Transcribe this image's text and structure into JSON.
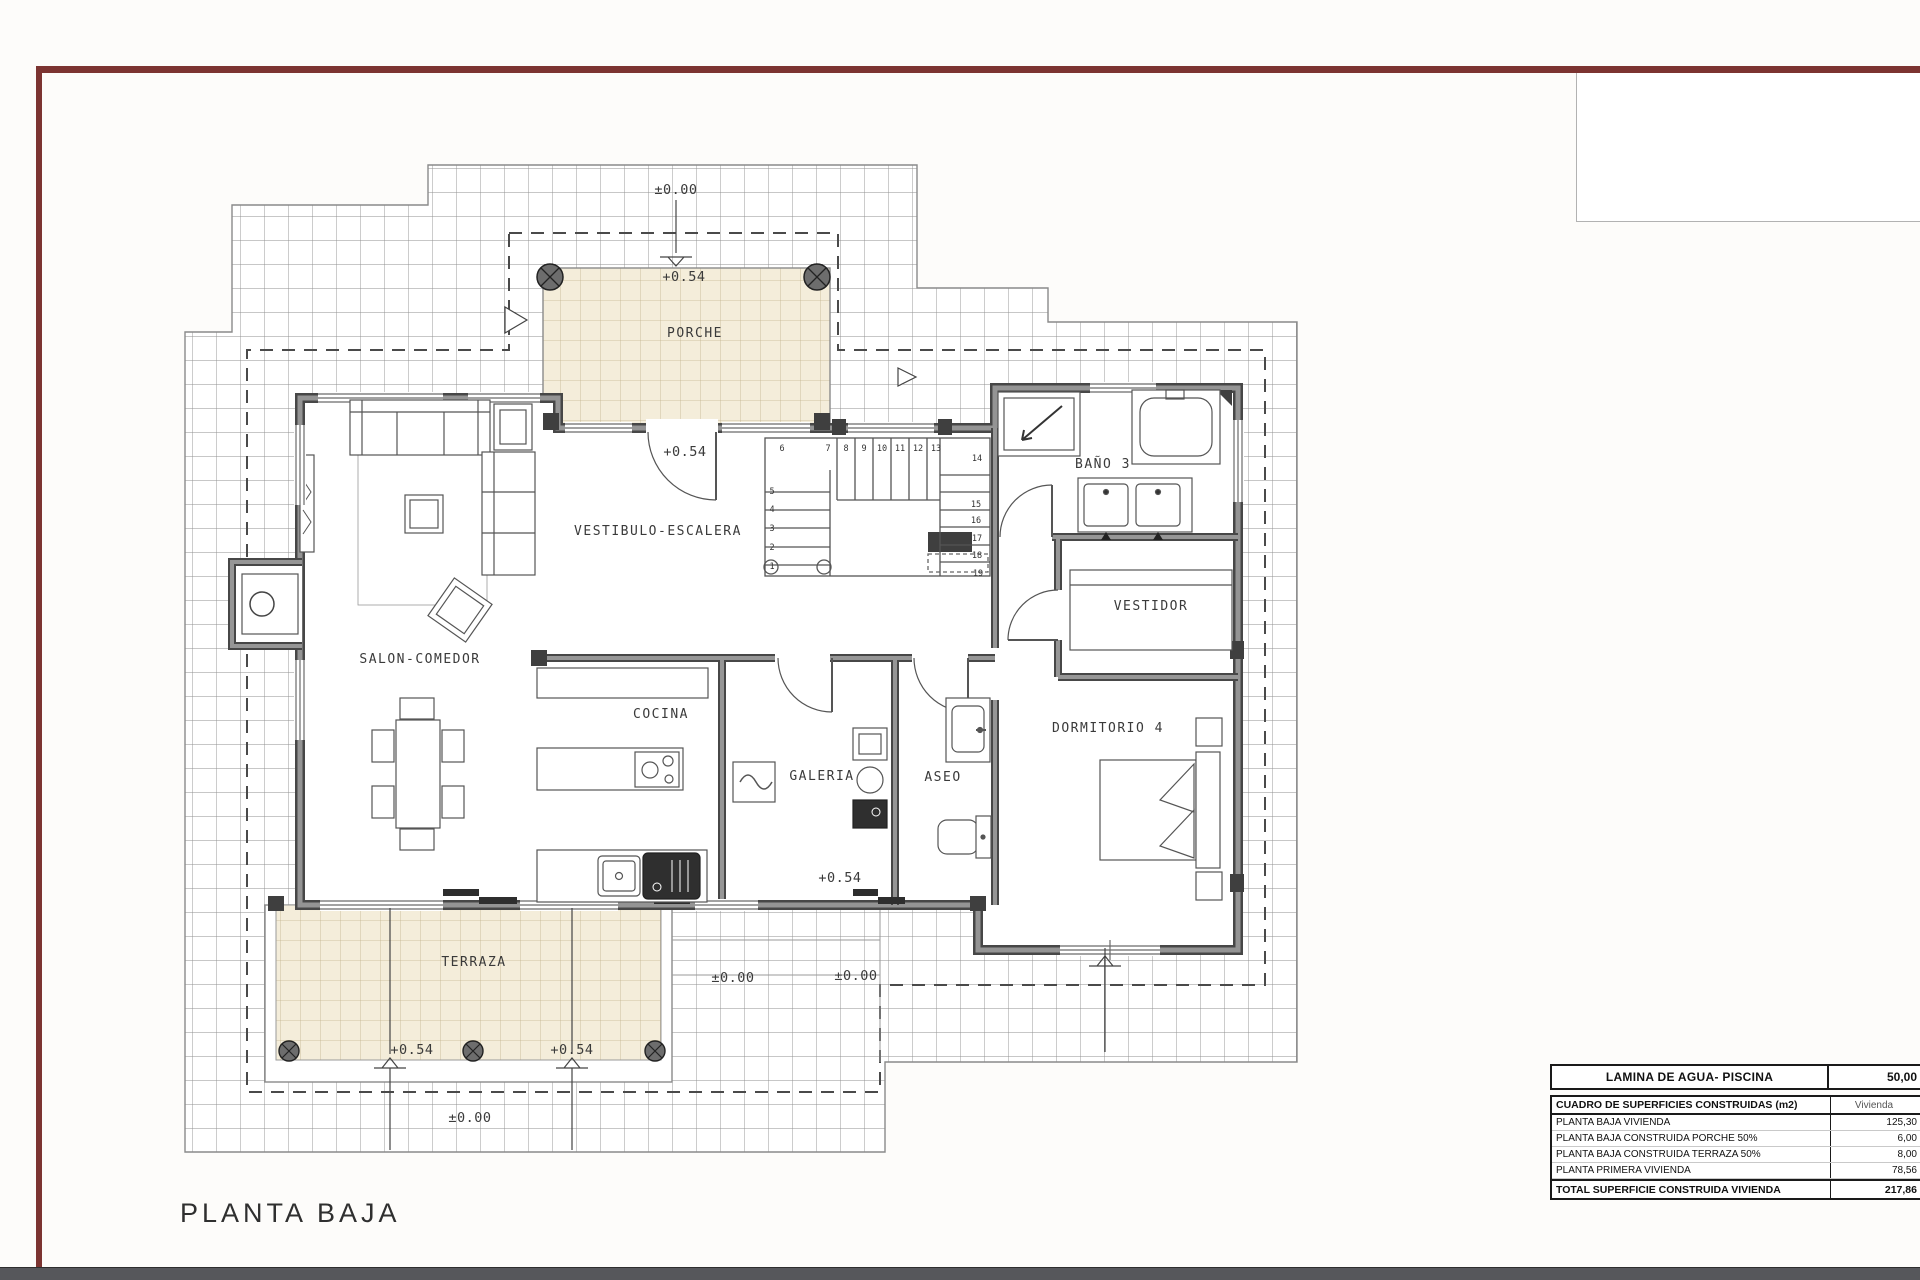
{
  "page": {
    "title": "PLANTA BAJA",
    "frame_color": "#7c3431",
    "footer_color": "#56575b",
    "paper_color": "#fdfcfa",
    "tile_color": "#f4edda",
    "wall_color": "#6f6f6f"
  },
  "plan": {
    "rooms": [
      {
        "id": "porche",
        "label": "PORCHE"
      },
      {
        "id": "vestibulo",
        "label": "VESTIBULO-ESCALERA"
      },
      {
        "id": "salon",
        "label": "SALON-COMEDOR"
      },
      {
        "id": "cocina",
        "label": "COCINA"
      },
      {
        "id": "galeria",
        "label": "GALERIA"
      },
      {
        "id": "aseo",
        "label": "ASEO"
      },
      {
        "id": "bano3",
        "label": "BAÑO 3"
      },
      {
        "id": "vestidor",
        "label": "VESTIDOR"
      },
      {
        "id": "dormitorio4",
        "label": "DORMITORIO 4"
      },
      {
        "id": "terraza",
        "label": "TERRAZA"
      }
    ],
    "levels": [
      {
        "text": "±0.00"
      },
      {
        "text": "+0.54"
      },
      {
        "text": "+0.54"
      },
      {
        "text": "+0.54"
      },
      {
        "text": "±0.00"
      },
      {
        "text": "±0.00"
      },
      {
        "text": "+0.54"
      },
      {
        "text": "+0.54"
      },
      {
        "text": "±0.00"
      }
    ],
    "stair_numbers": [
      "1",
      "2",
      "3",
      "4",
      "5",
      "6",
      "7",
      "8",
      "9",
      "10",
      "11",
      "12",
      "13",
      "14",
      "15",
      "16",
      "17",
      "18",
      "19"
    ]
  },
  "tables": {
    "piscina": {
      "label": "LAMINA DE AGUA- PISCINA",
      "value": "50,00"
    },
    "superficies": {
      "header": {
        "label": "CUADRO DE SUPERFICIES CONSTRUIDAS (m2)",
        "value": "Vivienda"
      },
      "rows": [
        {
          "label": "PLANTA BAJA VIVIENDA",
          "value": "125,30"
        },
        {
          "label": "PLANTA BAJA CONSTRUIDA PORCHE 50%",
          "value": "6,00"
        },
        {
          "label": "PLANTA BAJA CONSTRUIDA TERRAZA 50%",
          "value": "8,00"
        },
        {
          "label": "PLANTA PRIMERA VIVIENDA",
          "value": "78,56"
        }
      ],
      "total": {
        "label": "TOTAL SUPERFICIE CONSTRUIDA VIVIENDA",
        "value": "217,86"
      }
    }
  }
}
